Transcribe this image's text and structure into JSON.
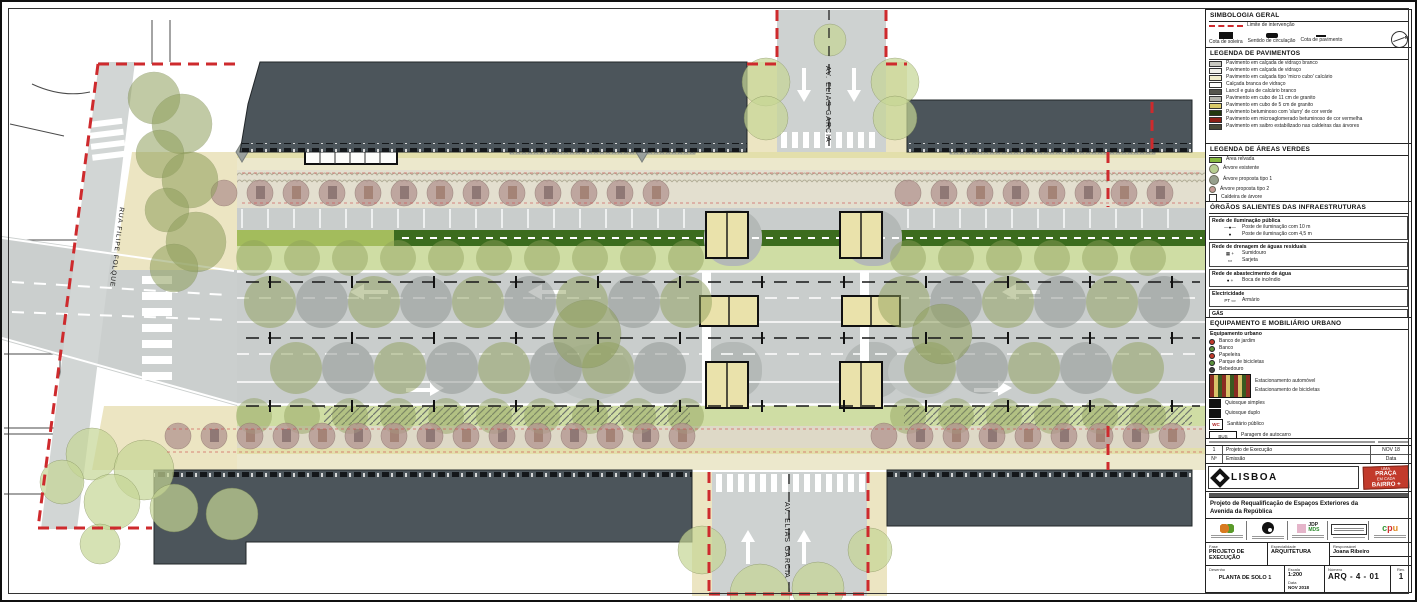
{
  "plan": {
    "labels": {
      "cross_street_north": "AV. ELIAS GARCIA",
      "cross_street_south": "AV. ELIAS GARCIA",
      "west_street": "RUA FILIPE FOLQUE"
    },
    "tree_colors": {
      "olive": "#8f9f5c",
      "gray": "#8d9490",
      "light": "#c6d695",
      "mauve": "#b29490"
    },
    "canopy_rows": [
      {
        "y": 300,
        "x0": 268,
        "x1": 688,
        "step": 52,
        "r": 26,
        "o": 0.5,
        "alt": true
      },
      {
        "y": 300,
        "x0": 902,
        "x1": 1186,
        "step": 52,
        "r": 26,
        "o": 0.5,
        "alt": true
      },
      {
        "y": 366,
        "x0": 294,
        "x1": 688,
        "step": 52,
        "r": 26,
        "o": 0.5,
        "alt": true
      },
      {
        "y": 366,
        "x0": 928,
        "x1": 1186,
        "step": 52,
        "r": 26,
        "o": 0.5,
        "alt": true
      },
      {
        "y": 256,
        "x0": 252,
        "x1": 690,
        "step": 48,
        "r": 18,
        "o": 0.45,
        "alt": false
      },
      {
        "y": 256,
        "x0": 906,
        "x1": 1190,
        "step": 48,
        "r": 18,
        "o": 0.45,
        "alt": false
      },
      {
        "y": 414,
        "x0": 252,
        "x1": 690,
        "step": 48,
        "r": 18,
        "o": 0.45,
        "alt": false
      },
      {
        "y": 414,
        "x0": 906,
        "x1": 1190,
        "step": 48,
        "r": 18,
        "o": 0.45,
        "alt": false
      }
    ],
    "mauve_rows": [
      {
        "y": 191,
        "x0": 222,
        "x1": 688,
        "step": 36,
        "r": 13
      },
      {
        "y": 191,
        "x0": 906,
        "x1": 1188,
        "step": 36,
        "r": 13
      },
      {
        "y": 434,
        "x0": 176,
        "x1": 688,
        "step": 36,
        "r": 13
      },
      {
        "y": 434,
        "x0": 882,
        "x1": 1188,
        "step": 36,
        "r": 13
      }
    ],
    "clusters": [
      {
        "color": "olive",
        "o": 0.55,
        "trees": [
          [
            152,
            96,
            26
          ],
          [
            180,
            122,
            30
          ],
          [
            158,
            152,
            24
          ],
          [
            188,
            178,
            28
          ],
          [
            165,
            208,
            22
          ],
          [
            194,
            240,
            30
          ],
          [
            172,
            266,
            24
          ],
          [
            585,
            332,
            34
          ],
          [
            940,
            332,
            30
          ]
        ]
      },
      {
        "color": "light",
        "o": 0.7,
        "trees": [
          [
            90,
            452,
            26
          ],
          [
            142,
            468,
            30
          ],
          [
            110,
            500,
            28
          ],
          [
            172,
            506,
            24
          ],
          [
            230,
            512,
            26
          ],
          [
            98,
            542,
            20
          ],
          [
            60,
            480,
            22
          ],
          [
            764,
            80,
            24
          ],
          [
            764,
            116,
            22
          ],
          [
            893,
            80,
            24
          ],
          [
            893,
            116,
            22
          ],
          [
            828,
            38,
            16
          ],
          [
            700,
            548,
            24
          ],
          [
            758,
            592,
            30
          ],
          [
            816,
            586,
            26
          ],
          [
            868,
            548,
            22
          ]
        ]
      }
    ],
    "axes": {
      "ys": [
        280,
        336,
        404
      ],
      "x0": 244,
      "x1": 1198,
      "tick_step": 82
    },
    "street_axes": [
      {
        "x": 827,
        "y0": 8,
        "y1": 148
      },
      {
        "x": 787,
        "y0": 472,
        "y1": 592
      }
    ],
    "parking_rows": [
      {
        "y": 207,
        "h": 19,
        "x0": 240,
        "x1": 688,
        "step": 26
      },
      {
        "y": 207,
        "h": 19,
        "x0": 906,
        "x1": 1190,
        "step": 26
      }
    ],
    "furniture_rows": [
      {
        "y": 184,
        "x0": 240,
        "x1": 688,
        "step": 36
      },
      {
        "y": 184,
        "x0": 924,
        "x1": 1188,
        "step": 36
      },
      {
        "y": 427,
        "x0": 194,
        "x1": 688,
        "step": 36
      },
      {
        "y": 427,
        "x0": 900,
        "x1": 1188,
        "step": 36
      }
    ]
  },
  "panel": {
    "simbologia": {
      "title": "SIMBOLOGIA GERAL",
      "limite": "Limite de intervenção",
      "cota_soleira": "Cota de soleira",
      "sentido": "Sentido de circulação",
      "cota_pav": "Cota de pavimento",
      "north": "N"
    },
    "pavimentos": {
      "title": "LEGENDA DE PAVIMENTOS",
      "items": [
        {
          "color": "#c9c9c1",
          "label": "Pavimento em calçada de vidraço branco"
        },
        {
          "color": "#f2f2ea",
          "label": "Pavimento em calçada de vidraço"
        },
        {
          "color": "#f2eecb",
          "label": "Pavimento em calçada tipo 'micro cubo' calcário"
        },
        {
          "color": "#ffffff",
          "label": "Calçada branca de vidraço"
        },
        {
          "color": "#55554d",
          "label": "Lancil e guia de calcário branco"
        },
        {
          "color": "#b4b4ac",
          "label": "Pavimento em cubo de 11 cm de granito"
        },
        {
          "color": "#d9ca6a",
          "label": "Pavimento em cubo de 5 cm de granito"
        },
        {
          "color": "#23380f",
          "label": "Pavimento betuminoso com 'slurry' de cor verde"
        },
        {
          "color": "#8c1f15",
          "label": "Pavimento em microaglomerado betuminoso de cor vermelha"
        },
        {
          "color": "#4a4a38",
          "label": "Pavimento em saibro estabilizado nas caldeiras das árvores"
        }
      ]
    },
    "verdes": {
      "title": "LEGENDA DE ÁREAS VERDES",
      "items": [
        {
          "shape": "rect",
          "color": "#86b93f",
          "label": "Área relvada"
        },
        {
          "shape": "circle",
          "color": "#b8cf92",
          "label": "Árvore existente"
        },
        {
          "shape": "circle",
          "color": "#97a08e",
          "label": "Árvore proposta tipo 1"
        },
        {
          "shape": "circle-small",
          "color": "#c59b97",
          "label": "Árvore proposta tipo 2"
        },
        {
          "shape": "square-outline",
          "color": "#ffffff",
          "label": "Caldeira de árvore"
        }
      ]
    },
    "orgaos": {
      "title": "ÓRGÃOS SALIENTES DAS INFRAESTRUTURAS",
      "groups": [
        {
          "title": "Rede de iluminação pública",
          "items": [
            {
              "sym": "—●—",
              "label": "Poste de iluminação com 10 m"
            },
            {
              "sym": "●",
              "label": "Poste de iluminação com 4,5 m"
            }
          ]
        },
        {
          "title": "Rede de drenagem de águas residuais",
          "items": [
            {
              "sym": "▦ +",
              "label": "Sumidouro"
            },
            {
              "sym": "▭",
              "label": "Sarjeta"
            }
          ]
        },
        {
          "title": "Rede de abastecimento de água",
          "items": [
            {
              "sym": "● +",
              "label": "Boca de incêndio"
            }
          ]
        },
        {
          "title": "Electricidade",
          "items": [
            {
              "sym": "PT ▭",
              "label": "Armário"
            }
          ]
        },
        {
          "title": "GÁS",
          "items": [
            {
              "sym": "▭",
              "label": "Armário"
            }
          ]
        }
      ]
    },
    "equipamento": {
      "title": "EQUIPAMENTO E MOBILIÁRIO URBANO",
      "subtitle": "Equipamento urbano",
      "dots": [
        {
          "color": "#c0392b",
          "label": "Banco de jardim"
        },
        {
          "color": "#5a8f3c",
          "label": "Banco"
        },
        {
          "color": "#c0392b",
          "label": "Papeleira"
        },
        {
          "color": "#5a8f3c",
          "label": "Parque de bicicletas"
        },
        {
          "color": "#444444",
          "label": "Bebedouro"
        }
      ],
      "esplanada_labels": [
        "Estacionamento automóvel",
        "Estacionamento de bicicletas"
      ],
      "quiosque1": "Quiosque simples",
      "quiosque2": "Quiosque duplo",
      "wc_label": "Sanitário público",
      "wc_glyph": "WC",
      "bus_text": "BUS",
      "bus_label": "Paragem de autocarro"
    },
    "revisions": {
      "rows": [
        {
          "n": "1",
          "desc": "Projeto de Execução",
          "date": "NOV 18"
        }
      ],
      "head": [
        "Nº",
        "Emissão",
        "Data"
      ]
    },
    "titleblock": {
      "municipality": "LISBOA",
      "stamp": {
        "l1": "UMA",
        "l2": "PRAÇA",
        "l3": "EM CADA",
        "l4": "BAIRRO +"
      },
      "project_title_line1": "Projeto de Requalificação de Espaços Exteriores da",
      "project_title_line2": "Avenida da República",
      "partners": {
        "jdp": "JDP",
        "mds": "MDS",
        "cpu_c": "c",
        "cpu_p": "p",
        "cpu_u": "u"
      },
      "fields": {
        "fase_label": "Fase",
        "fase": "PROJETO DE EXECUÇÃO",
        "esp_label": "Especialidade",
        "especialidade": "ARQUITETURA",
        "resp_label": "Responsável",
        "responsavel": "Joana Ribeiro",
        "escala_label": "Escala",
        "escala": "1:200",
        "data_label": "Data",
        "data": "NOV 2018",
        "desenho_label": "Desenho",
        "desenho": "PLANTA DE SOLO 1",
        "numero_label": "Número",
        "numero": "ARQ - 4 - 01",
        "rev_label": "Rev.",
        "rev": "1"
      }
    }
  }
}
